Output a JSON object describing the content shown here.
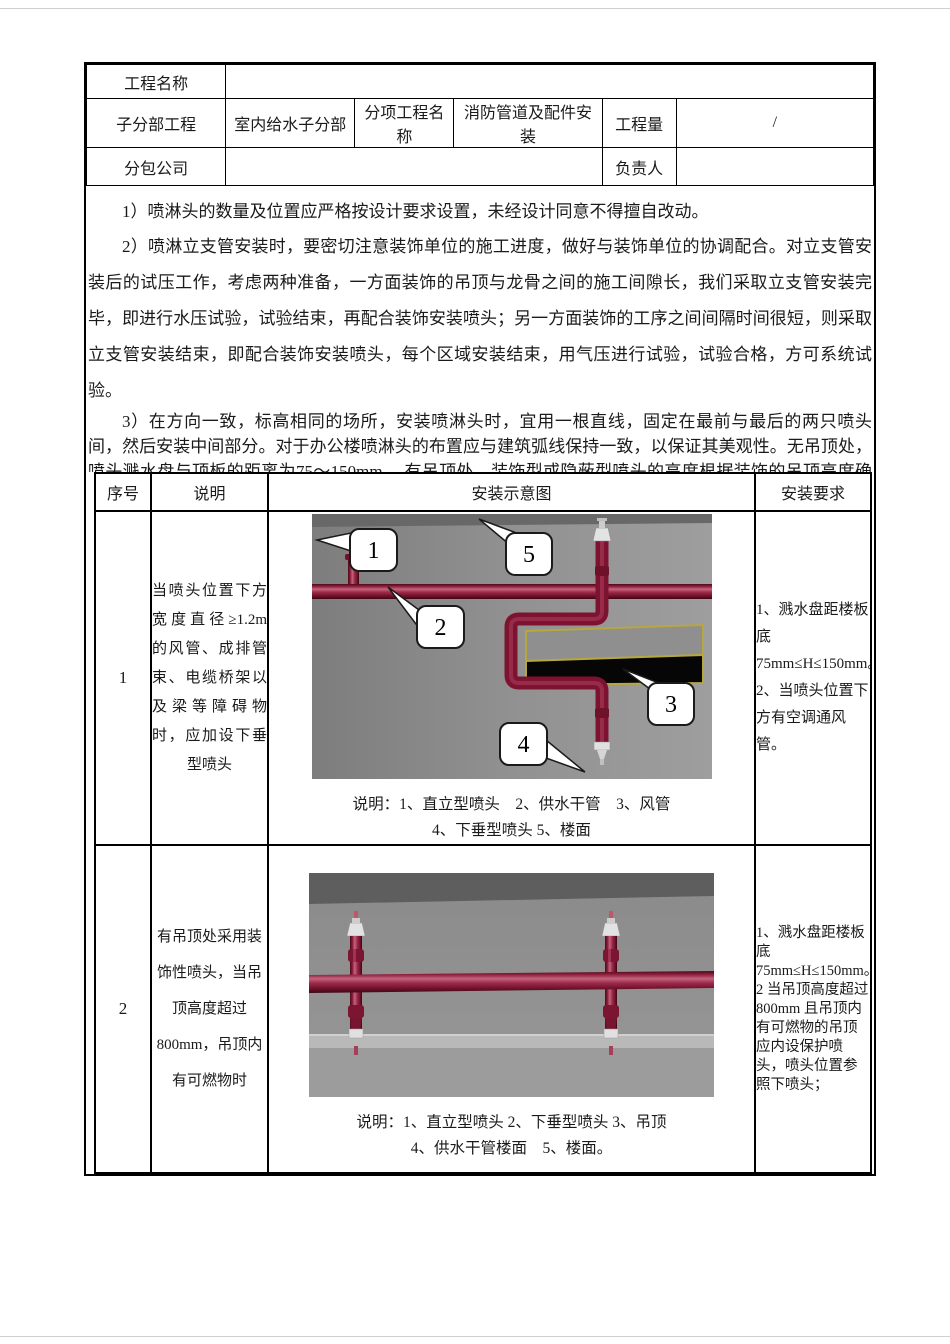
{
  "info": {
    "project_name_label": "工程名称",
    "project_name_value": "",
    "sub_division_label": "子分部工程",
    "sub_division_value": "室内给水子分部",
    "sub_item_label": "分项工程名称",
    "sub_item_value": "消防管道及配件安装",
    "quantity_label": "工程量",
    "quantity_value": "/",
    "subcontractor_label": "分包公司",
    "subcontractor_value": "",
    "manager_label": "负责人",
    "manager_value": ""
  },
  "paragraphs": {
    "p1": "1）喷淋头的数量及位置应严格按设计要求设置，未经设计同意不得擅自改动。",
    "p2": "2）喷淋立支管安装时，要密切注意装饰单位的施工进度，做好与装饰单位的协调配合。对立支管安装后的试压工作，考虑两种准备，一方面装饰的吊顶与龙骨之间的施工间隙长，我们采取立支管安装完毕，即进行水压试验，试验结束，再配合装饰安装喷头；另一方面装饰的工序之间间隔时间很短，则采取立支管安装结束，即配合装饰安装喷头，每个区域安装结束，用气压进行试验，试验合格，方可系统试验。",
    "p3": "3）在方向一致，标高相同的场所，安装喷淋头时，宜用一根直线，固定在最前与最后的两只喷头间，然后安装中间部分。对于办公楼喷淋头的布置应与建筑弧线保持一致，以保证其美观性。无吊顶处，喷头溅水盘与顶板的距离为75～150mm ，有吊顶处，装饰型或隐蔽型喷头的高度根据装饰的吊顶高度确定。",
    "p4": "4）喷淋头的主要安装形式如下表"
  },
  "table": {
    "headers": [
      "序号",
      "说明",
      "安装示意图",
      "安装要求"
    ],
    "rows": [
      {
        "no": "1",
        "description": "当喷头位置下方宽度直径≥1.2m 的风管、成排管束、电缆桥架以及梁等障碍物时，应加设下垂型喷头",
        "caption_line1": "说明：1、直立型喷头　2、供水干管　3、风管",
        "caption_line2": "4、下垂型喷头 5、楼面",
        "requirements": "1、溅水盘距楼板底75mm≤H≤150mm。\n2、当喷头位置下方有空调通风管。",
        "callouts": [
          "1",
          "2",
          "3",
          "4",
          "5"
        ]
      },
      {
        "no": "2",
        "description": "有吊顶处采用装饰性喷头，当吊顶高度超过800mm，吊顶内有可燃物时",
        "caption_line1": "说明：1、直立型喷头 2、下垂型喷头 3、吊顶",
        "caption_line2": "4、供水干管楼面　5、楼面。",
        "requirements": "1、溅水盘距楼板底75mm≤H≤150mm。\n2 当吊顶高度超过 800mm 且吊顶内有可燃物的吊顶应内设保护喷头，喷头位置参照下喷头；"
      }
    ]
  },
  "colors": {
    "pipe_red": "#8e1c3a",
    "pipe_dark": "#4a0a1a",
    "pipe_highlight": "#c4647e",
    "duct_yellow": "#b6a73f",
    "diagram_bg": "#8f8f8f",
    "ceiling_dark": "#5e5e5e",
    "suspended_ceiling_light": "#b9b9b9",
    "callout_fill": "#ffffff",
    "border_black": "#000000"
  }
}
